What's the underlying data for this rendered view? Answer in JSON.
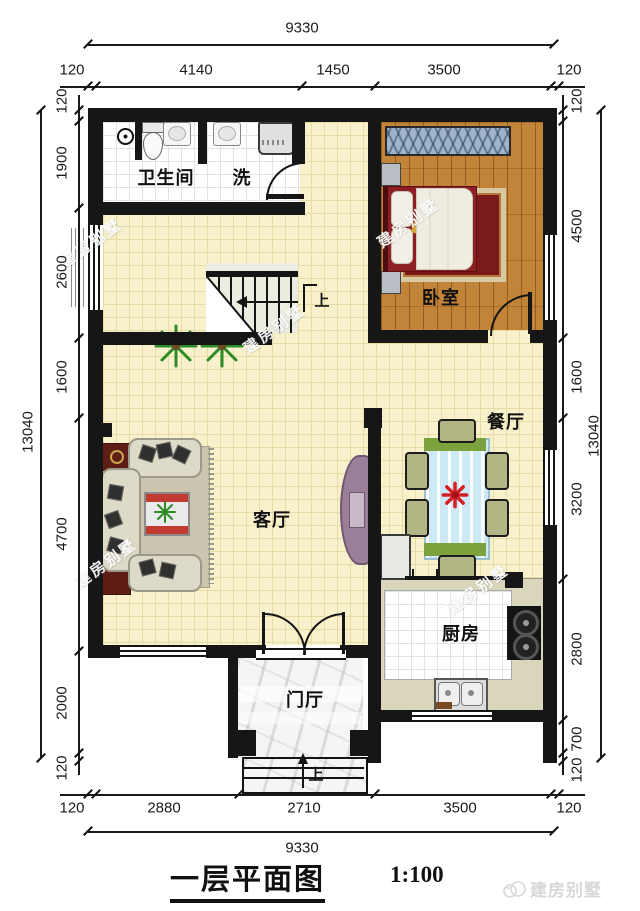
{
  "title": {
    "name": "一层平面图",
    "scale": "1:100"
  },
  "brand": {
    "name": "建房别墅"
  },
  "watermark": {
    "text": "建房别墅"
  },
  "rooms": {
    "bathroom": "卫生间",
    "wash": "洗",
    "bedroom": "卧室",
    "dining": "餐厅",
    "living": "客厅",
    "kitchen": "厨房",
    "foyer": "门厅"
  },
  "labels": {
    "stairs_up": "上",
    "entry_up": "上"
  },
  "dims": {
    "top": {
      "total": "9330",
      "segments": [
        "120",
        "4140",
        "1450",
        "3500",
        "120"
      ]
    },
    "bottom": {
      "total": "9330",
      "segments": [
        "120",
        "2880",
        "2710",
        "3500",
        "120"
      ]
    },
    "left": {
      "total": "13040",
      "segments": [
        "120",
        "1900",
        "2600",
        "1600",
        "4700",
        "2000",
        "120"
      ]
    },
    "right": {
      "total": "13040",
      "segments": [
        "120",
        "4500",
        "1600",
        "3200",
        "2800",
        "700",
        "120"
      ]
    }
  },
  "colors": {
    "wall": "#161616",
    "floor_tile": "#F8F1CC",
    "bath_tile": "#FFFFFF",
    "wood": "#C18438",
    "counter": "#D9D6BC",
    "marble": "#F5F5F5",
    "sofa": "#DEDAC8",
    "corner_table": "#5E1D15",
    "tv_stand": "#9B7F99",
    "dining_table": "#CDE9F5",
    "dining_green": "#7CA23E",
    "flower_red": "#D41F26",
    "plant_green": "#2E8B27",
    "bed_red": "#8E1F24",
    "wardrobe_blue": "#9FB4CC"
  }
}
